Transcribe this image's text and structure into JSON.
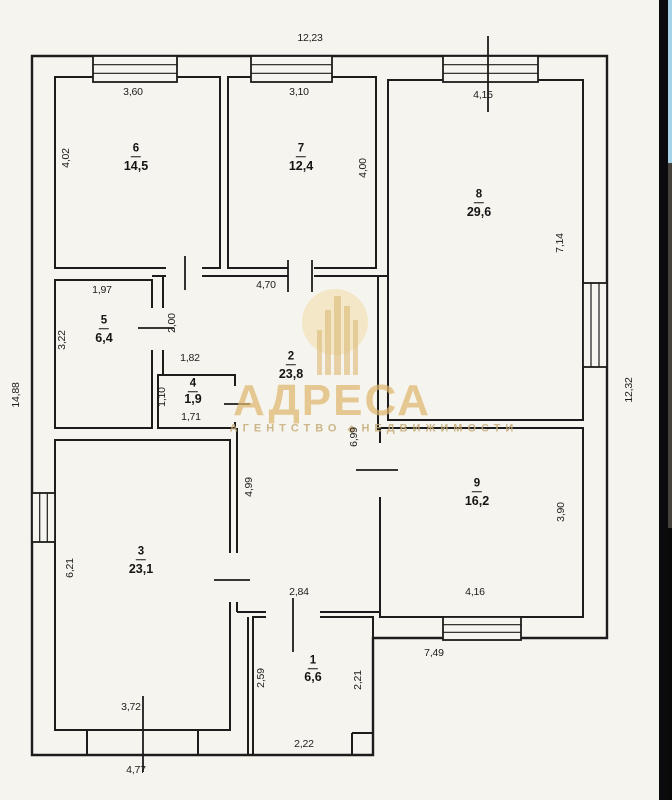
{
  "document": {
    "kind": "floor plan scan"
  },
  "watermark": {
    "brand": "АДРЕСА",
    "subtitle_word1": "АГЕНТСТВО",
    "subtitle_word2": "НЕДВИЖИМОСТИ",
    "color": "#dcb36a"
  },
  "colors": {
    "paper": "#f6f4ee",
    "line": "#1c1c1c",
    "watermark_gold": "#dcb36a",
    "divider_black": "#0b0b0d",
    "sliver_sky": "#a5d2e8",
    "sliver_building": "#46413a"
  },
  "exterior": {
    "top": "12,23",
    "left": "14,88",
    "right": "12,32",
    "bottom_left": "4,77",
    "bottom_right": "7,49"
  },
  "rooms": {
    "1": {
      "number": "1",
      "area": "6,6",
      "dims": {
        "top": "2,84",
        "left": "2,59",
        "right": "2,21",
        "bottom": "2,22"
      }
    },
    "2": {
      "number": "2",
      "area": "23,8",
      "dims": {
        "top": "4,70",
        "niche": "1,82",
        "door": "2,00",
        "left": "4,99",
        "right": "6,99"
      }
    },
    "3": {
      "number": "3",
      "area": "23,1",
      "dims": {
        "left": "6,21",
        "bottom": "3,72"
      }
    },
    "4": {
      "number": "4",
      "area": "1,9",
      "dims": {
        "left": "1,10",
        "bottom": "1,71"
      }
    },
    "5": {
      "number": "5",
      "area": "6,4",
      "dims": {
        "top": "1,97",
        "left": "3,22"
      }
    },
    "6": {
      "number": "6",
      "area": "14,5",
      "dims": {
        "top": "3,60",
        "left": "4,02"
      }
    },
    "7": {
      "number": "7",
      "area": "12,4",
      "dims": {
        "top": "3,10",
        "right": "4,00"
      }
    },
    "8": {
      "number": "8",
      "area": "29,6",
      "dims": {
        "top": "4,15",
        "right": "7,14"
      }
    },
    "9": {
      "number": "9",
      "area": "16,2",
      "dims": {
        "right": "3,90",
        "bottom": "4,16"
      }
    }
  }
}
